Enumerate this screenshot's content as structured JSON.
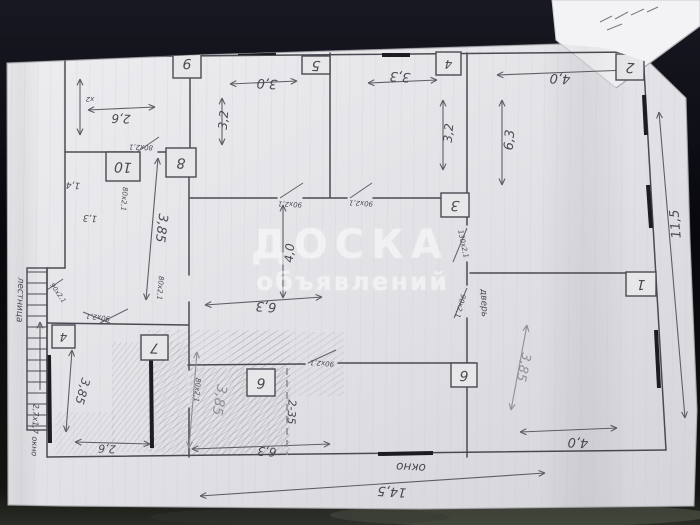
{
  "watermark": {
    "line1": "ДОСКА",
    "line2": "объявлений",
    "color": "#ffffff"
  },
  "photo": {
    "bg_top": "#181822",
    "bg_mid": "#07070d",
    "bg_bottom": "#141411",
    "blob1": "#596052",
    "blob2": "#343831",
    "paper_light": "#ededf0",
    "paper_dark": "#d6d6da",
    "sheet2_fill": "#f3f3f5"
  },
  "paper": {
    "polygon": "7,63 200,55 560,44 606,48 650,63 686,98 690,240 697,410 694,506 420,509 60,506 8,505",
    "stripe_color": "#b9b9c9",
    "sheet2_polygon": "552,0 700,0 700,26 616,88 556,40",
    "sheet2_crease": [
      616,
      88,
      700,
      26
    ],
    "sheet2_scribbles": [
      [
        600,
        22,
        612,
        16
      ],
      [
        615,
        19,
        628,
        12
      ],
      [
        631,
        15,
        644,
        9
      ],
      [
        647,
        12,
        658,
        7
      ],
      [
        607,
        30,
        622,
        24
      ]
    ]
  },
  "plan": {
    "ink": "#4a4a52",
    "ink_light": "#5e5e66",
    "pencil": "#8f8f98",
    "paper_shadow": "#9a9a9e",
    "walls": [
      [
        65,
        57,
        643,
        52
      ],
      [
        643,
        52,
        666,
        450
      ],
      [
        666,
        450,
        47,
        457
      ],
      [
        47,
        268,
        47,
        457
      ],
      [
        65,
        57,
        65,
        268
      ],
      [
        47,
        268,
        65,
        268
      ],
      [
        190,
        57,
        190,
        152
      ],
      [
        65,
        152,
        133,
        152
      ],
      [
        158,
        152,
        190,
        152
      ],
      [
        189,
        152,
        189,
        275
      ],
      [
        189,
        302,
        189,
        370
      ],
      [
        189,
        408,
        189,
        457
      ],
      [
        47,
        323,
        188,
        325
      ],
      [
        188,
        365,
        305,
        364
      ],
      [
        338,
        363,
        475,
        363
      ],
      [
        467,
        53,
        467,
        225
      ],
      [
        467,
        262,
        467,
        285
      ],
      [
        467,
        318,
        467,
        457
      ],
      [
        190,
        198,
        277,
        198
      ],
      [
        303,
        198,
        347,
        198
      ],
      [
        373,
        198,
        441,
        198
      ],
      [
        330,
        53,
        330,
        197
      ],
      [
        470,
        273,
        648,
        273
      ]
    ],
    "thick_marks": [
      [
        150,
        54,
        172,
        54
      ],
      [
        238,
        53,
        276,
        53
      ],
      [
        382,
        55,
        410,
        55
      ],
      [
        644,
        95,
        646,
        135
      ],
      [
        648,
        185,
        651,
        228
      ],
      [
        656,
        330,
        659,
        388
      ],
      [
        378,
        454,
        433,
        453
      ],
      [
        49,
        355,
        50,
        443
      ],
      [
        151,
        358,
        152,
        448
      ]
    ],
    "door_swings": [
      [
        137,
        152,
        159,
        137
      ],
      [
        280,
        198,
        303,
        183
      ],
      [
        350,
        198,
        372,
        183
      ],
      [
        467,
        228,
        453,
        262
      ],
      [
        467,
        288,
        454,
        318
      ],
      [
        100,
        323,
        128,
        309
      ],
      [
        308,
        363,
        336,
        350
      ],
      [
        47,
        290,
        63,
        279
      ],
      [
        83,
        312,
        112,
        324
      ]
    ],
    "arrows": [
      [
        88,
        110,
        155,
        107,
        "b",
        "i"
      ],
      [
        80,
        79,
        80,
        135,
        "b",
        "i"
      ],
      [
        230,
        84,
        297,
        81,
        "b",
        "i"
      ],
      [
        222,
        98,
        222,
        145,
        "b",
        "i"
      ],
      [
        368,
        83,
        437,
        80,
        "b",
        "i"
      ],
      [
        443,
        100,
        443,
        170,
        "b",
        "i"
      ],
      [
        497,
        75,
        628,
        70,
        "b",
        "i"
      ],
      [
        502,
        100,
        502,
        185,
        "b",
        "i"
      ],
      [
        659,
        112,
        685,
        418,
        "b",
        "i"
      ],
      [
        200,
        496,
        545,
        473,
        "b",
        "i"
      ],
      [
        283,
        205,
        283,
        298,
        "b",
        "i"
      ],
      [
        205,
        305,
        322,
        297,
        "b",
        "i"
      ],
      [
        158,
        158,
        146,
        300,
        "b",
        "i"
      ],
      [
        527,
        325,
        511,
        410,
        "b",
        "p"
      ],
      [
        520,
        432,
        617,
        428,
        "b",
        "i"
      ],
      [
        72,
        350,
        66,
        432,
        "b",
        "i"
      ],
      [
        75,
        442,
        150,
        444,
        "b",
        "i"
      ],
      [
        192,
        449,
        330,
        444,
        "b",
        "i"
      ],
      [
        197,
        352,
        189,
        448,
        "b",
        "p"
      ],
      [
        40,
        390,
        40,
        322,
        "e",
        "i"
      ],
      [
        255,
        391,
        264,
        381,
        "e",
        "p"
      ]
    ],
    "dashed_partition": {
      "x": 287,
      "y1": 368,
      "y2": 455
    },
    "stairs": {
      "x1": 27,
      "y1": 268,
      "x2": 47,
      "y2": 430,
      "rung_step": 11
    },
    "hatch_regions": [
      [
        112,
        342,
        76,
        110,
        "a",
        0.45
      ],
      [
        148,
        330,
        142,
        126,
        "b",
        0.5
      ],
      [
        190,
        368,
        100,
        87,
        "a",
        0.6
      ],
      [
        232,
        332,
        112,
        64,
        "b",
        0.4
      ],
      [
        55,
        412,
        60,
        43,
        "a",
        0.35
      ]
    ],
    "room_boxes": [
      {
        "x": 173,
        "y": 48,
        "w": 28,
        "h": 30,
        "number": "9"
      },
      {
        "x": 302,
        "y": 56,
        "w": 28,
        "h": 18,
        "number": "5"
      },
      {
        "x": 436,
        "y": 52,
        "w": 25,
        "h": 23,
        "number": "4"
      },
      {
        "x": 616,
        "y": 54,
        "w": 28,
        "h": 26,
        "number": "2"
      },
      {
        "x": 106,
        "y": 152,
        "w": 34,
        "h": 29,
        "number": "10"
      },
      {
        "x": 166,
        "y": 148,
        "w": 30,
        "h": 29,
        "number": "8"
      },
      {
        "x": 441,
        "y": 193,
        "w": 28,
        "h": 24,
        "number": "3"
      },
      {
        "x": 626,
        "y": 272,
        "w": 30,
        "h": 24,
        "number": "1"
      },
      {
        "x": 141,
        "y": 335,
        "w": 27,
        "h": 25,
        "number": "7"
      },
      {
        "x": 52,
        "y": 325,
        "w": 23,
        "h": 23,
        "number": "4"
      },
      {
        "x": 247,
        "y": 369,
        "w": 28,
        "h": 27,
        "number": "6"
      },
      {
        "x": 451,
        "y": 363,
        "w": 26,
        "h": 24,
        "number": "6"
      }
    ],
    "labels": [
      {
        "t": "2,6",
        "x": 121,
        "y": 118,
        "a": 182,
        "s": 12,
        "c": "i"
      },
      {
        "t": "3,0",
        "x": 267,
        "y": 83,
        "a": 183,
        "s": 13,
        "c": "i"
      },
      {
        "t": "3,2",
        "x": 224,
        "y": 120,
        "a": 275,
        "s": 12,
        "c": "i"
      },
      {
        "t": "3,3",
        "x": 400,
        "y": 76,
        "a": 184,
        "s": 13,
        "c": "i"
      },
      {
        "t": "3,2",
        "x": 449,
        "y": 133,
        "a": 275,
        "s": 12,
        "c": "i"
      },
      {
        "t": "4,0",
        "x": 560,
        "y": 78,
        "a": 183,
        "s": 13,
        "c": "i"
      },
      {
        "t": "6,3",
        "x": 510,
        "y": 140,
        "a": 275,
        "s": 13,
        "c": "i"
      },
      {
        "t": "11,5",
        "x": 676,
        "y": 224,
        "a": 265,
        "s": 13,
        "c": "i"
      },
      {
        "t": "3,85",
        "x": 161,
        "y": 228,
        "a": 97,
        "s": 13,
        "c": "i"
      },
      {
        "t": "4,0",
        "x": 290,
        "y": 253,
        "a": 275,
        "s": 12,
        "c": "i"
      },
      {
        "t": "6,3",
        "x": 266,
        "y": 306,
        "a": 184,
        "s": 13,
        "c": "i"
      },
      {
        "t": "3,85",
        "x": 523,
        "y": 367,
        "a": 102,
        "s": 13,
        "c": "p"
      },
      {
        "t": "4,0",
        "x": 578,
        "y": 442,
        "a": 183,
        "s": 13,
        "c": "i"
      },
      {
        "t": "14,5",
        "x": 392,
        "y": 491,
        "a": 184,
        "s": 13,
        "c": "i"
      },
      {
        "t": "окно",
        "x": 411,
        "y": 467,
        "a": 183,
        "s": 12,
        "c": "i"
      },
      {
        "t": "3,85",
        "x": 82,
        "y": 391,
        "a": 105,
        "s": 12,
        "c": "i"
      },
      {
        "t": "2,6",
        "x": 107,
        "y": 448,
        "a": 183,
        "s": 11,
        "c": "i"
      },
      {
        "t": "3,85",
        "x": 219,
        "y": 400,
        "a": 100,
        "s": 14,
        "c": "p"
      },
      {
        "t": "6,3",
        "x": 267,
        "y": 451,
        "a": 184,
        "s": 12,
        "c": "i"
      },
      {
        "t": "2-35",
        "x": 291,
        "y": 412,
        "a": 92,
        "s": 11,
        "c": "i"
      },
      {
        "t": "лестница",
        "x": 20,
        "y": 300,
        "a": 92,
        "s": 9,
        "c": "i"
      },
      {
        "t": "2,7x1,7 окно",
        "x": 35,
        "y": 430,
        "a": 92,
        "s": 8,
        "c": "i"
      },
      {
        "t": "80x2,1",
        "x": 141,
        "y": 147,
        "a": 182,
        "s": 7,
        "c": "i"
      },
      {
        "t": "80x2,1",
        "x": 124,
        "y": 199,
        "a": 95,
        "s": 7,
        "c": "i"
      },
      {
        "t": "1,4",
        "x": 73,
        "y": 185,
        "a": 183,
        "s": 9,
        "c": "i"
      },
      {
        "t": "1,3",
        "x": 90,
        "y": 218,
        "a": 183,
        "s": 9,
        "c": "i"
      },
      {
        "t": "90x2,1",
        "x": 290,
        "y": 204,
        "a": 183,
        "s": 7,
        "c": "i"
      },
      {
        "t": "90x2,1",
        "x": 361,
        "y": 203,
        "a": 183,
        "s": 7,
        "c": "i"
      },
      {
        "t": "80x2,1",
        "x": 160,
        "y": 288,
        "a": 95,
        "s": 7,
        "c": "i"
      },
      {
        "t": "130x2,1",
        "x": 463,
        "y": 244,
        "a": 78,
        "s": 7,
        "c": "i"
      },
      {
        "t": "90x2,1",
        "x": 460,
        "y": 306,
        "a": 105,
        "s": 7,
        "c": "i"
      },
      {
        "t": "дверь",
        "x": 484,
        "y": 303,
        "a": 88,
        "s": 9,
        "c": "i"
      },
      {
        "t": "90x2,1",
        "x": 58,
        "y": 293,
        "a": 55,
        "s": 6.5,
        "c": "i"
      },
      {
        "t": "90x2,1",
        "x": 98,
        "y": 317,
        "a": 187,
        "s": 7,
        "c": "i"
      },
      {
        "t": "80x2,1",
        "x": 197,
        "y": 390,
        "a": 95,
        "s": 7,
        "c": "i"
      },
      {
        "t": "90x2,1",
        "x": 322,
        "y": 363,
        "a": 184,
        "s": 7,
        "c": "i"
      },
      {
        "t": "x2",
        "x": 90,
        "y": 99,
        "a": 180,
        "s": 7,
        "c": "i"
      }
    ],
    "outer_dims": {
      "width_label": "14,5",
      "height_label": "11,5"
    }
  }
}
